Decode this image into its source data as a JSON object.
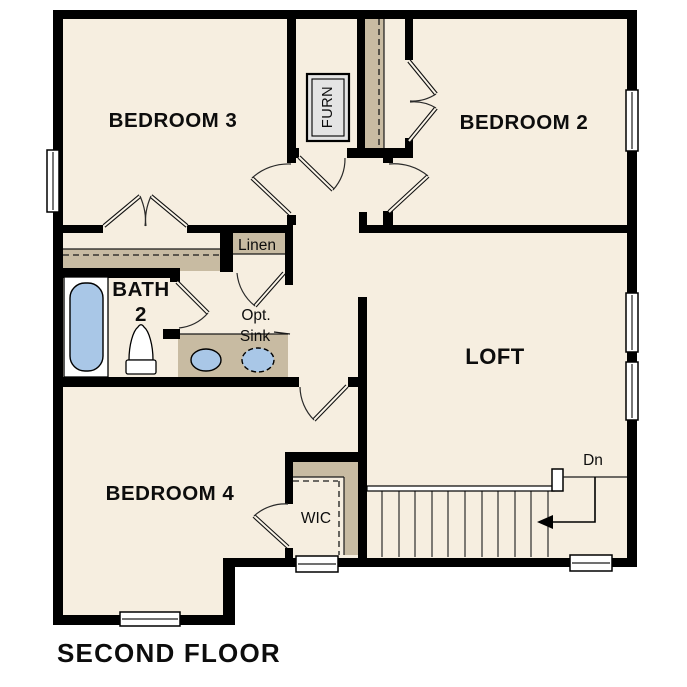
{
  "title": "SECOND FLOOR",
  "colors": {
    "floor": "#f6eee0",
    "wall": "#000000",
    "shelf_tan": "#c8bba2",
    "fixture_blue": "#a9c7e7",
    "appliance_gray": "#e4e4e4",
    "window_white": "#ffffff"
  },
  "rooms": {
    "bedroom3": {
      "label": "BEDROOM 3"
    },
    "bedroom2": {
      "label": "BEDROOM 2"
    },
    "bedroom4": {
      "label": "BEDROOM 4"
    },
    "loft": {
      "label": "LOFT"
    },
    "bath2": {
      "line1": "BATH",
      "line2": "2"
    },
    "wic": {
      "label": "WIC"
    },
    "linen": {
      "label": "Linen"
    },
    "furnace": {
      "label": "FURN"
    },
    "opt_sink": {
      "line1": "Opt.",
      "line2": "Sink"
    },
    "stairs": {
      "down_label": "Dn"
    }
  }
}
